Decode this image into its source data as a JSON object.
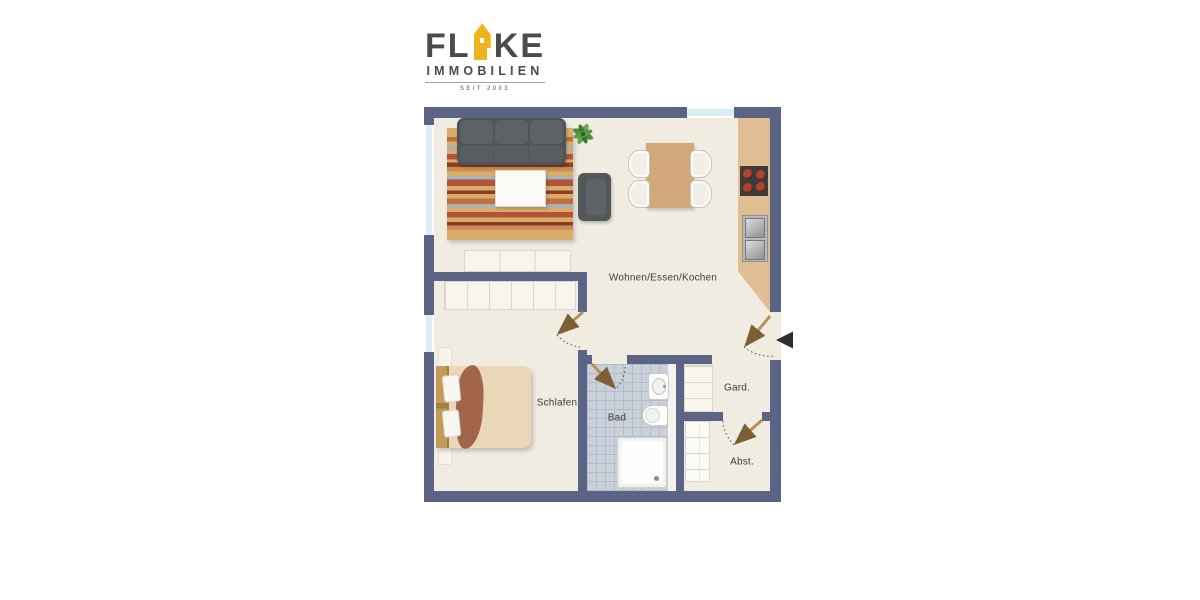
{
  "logo": {
    "word_start": "FL",
    "word_end": "KE",
    "house_icon_color": "#edb41e",
    "subtitle": "IMMOBILIEN",
    "since": "SEIT 2003"
  },
  "plan": {
    "rooms": [
      {
        "name": "living-dining-kitchen",
        "label": "Wohnen/Essen/Kochen"
      },
      {
        "name": "bedroom",
        "label": "Schlafen"
      },
      {
        "name": "bathroom",
        "label": "Bad"
      },
      {
        "name": "wardrobe",
        "label": "Gard."
      },
      {
        "name": "storage",
        "label": "Abst."
      }
    ],
    "colors": {
      "wall": "#5b6484",
      "floor": "#f0ece2",
      "bath_tiles": "#c9d0da",
      "window_glass": "#d9edf2",
      "kitchen_counter": "#e0bd92",
      "door_leaf": "#b98f57",
      "entrance_arrow": "#2e2e2e",
      "rug_base": "#d9ad69",
      "sofa": "#4f5457",
      "bed_blanket": "#a3644c"
    },
    "watermark": "··········"
  }
}
